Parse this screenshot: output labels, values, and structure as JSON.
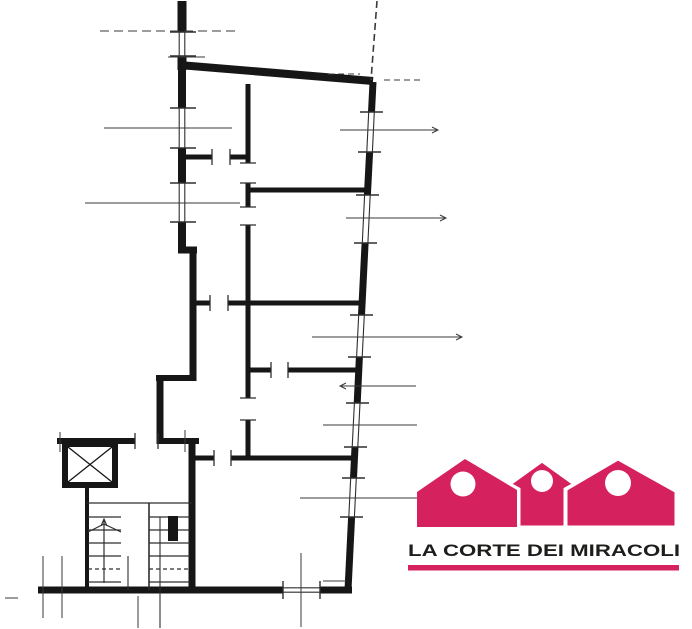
{
  "logo": {
    "text": "LA CORTE DEI MIRACOLI",
    "brand_color": "#d6215f",
    "text_color": "#1d1d1b",
    "icon": "three-houses-icon",
    "houses_count": 3
  },
  "plan": {
    "ink_color": "#161616",
    "thin_line_color": "#2e2e2e",
    "dimension_line_color": "#3a3a3a",
    "background": "#ffffff"
  }
}
